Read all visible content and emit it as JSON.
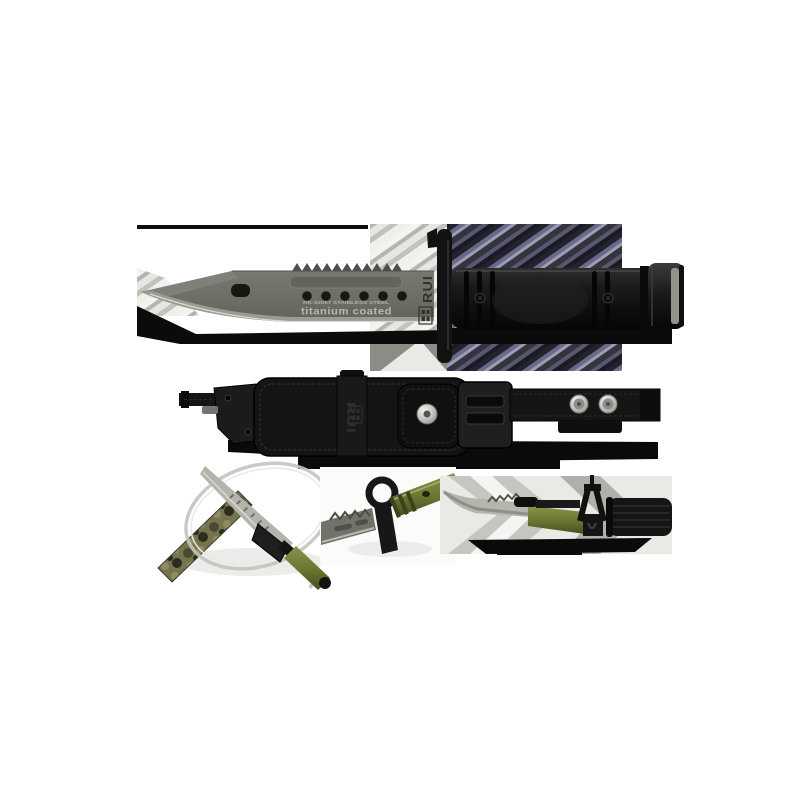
{
  "image": {
    "type": "product-photo-collage",
    "background": "#ffffff",
    "brand": "RUI",
    "views": [
      {
        "name": "knife-main",
        "description": "bayonet knife with titanium coated blade and black handle"
      },
      {
        "name": "sheath",
        "description": "black nylon sheath with belt strap and snaps"
      },
      {
        "name": "wire-cutter-detail",
        "description": "knife cutting wire with sheath tip, camo strap"
      },
      {
        "name": "muzzle-ring-detail",
        "description": "green handled bayonet with muzzle ring"
      },
      {
        "name": "rifle-mounted-detail",
        "description": "bayonet mounted under rifle barrel"
      }
    ]
  },
  "knife": {
    "blade_marking_small": "RK-32067  STAINLESS STEEL",
    "blade_marking_large": "titanium coated",
    "blade_brand": "RUI"
  },
  "sheath": {
    "brand": "RUI"
  },
  "colors": {
    "blade": "#6f6f68",
    "blade_bevel": "#9b9b92",
    "blade_edge_line": "#d8d8d2",
    "handle_black": "#141414",
    "backdrop_purple": "#43434f",
    "backdrop_grey": "#d6d6d1",
    "olive_handle": "#77823b",
    "silver": "#c9c9c4",
    "camo_base": "#76744e"
  }
}
